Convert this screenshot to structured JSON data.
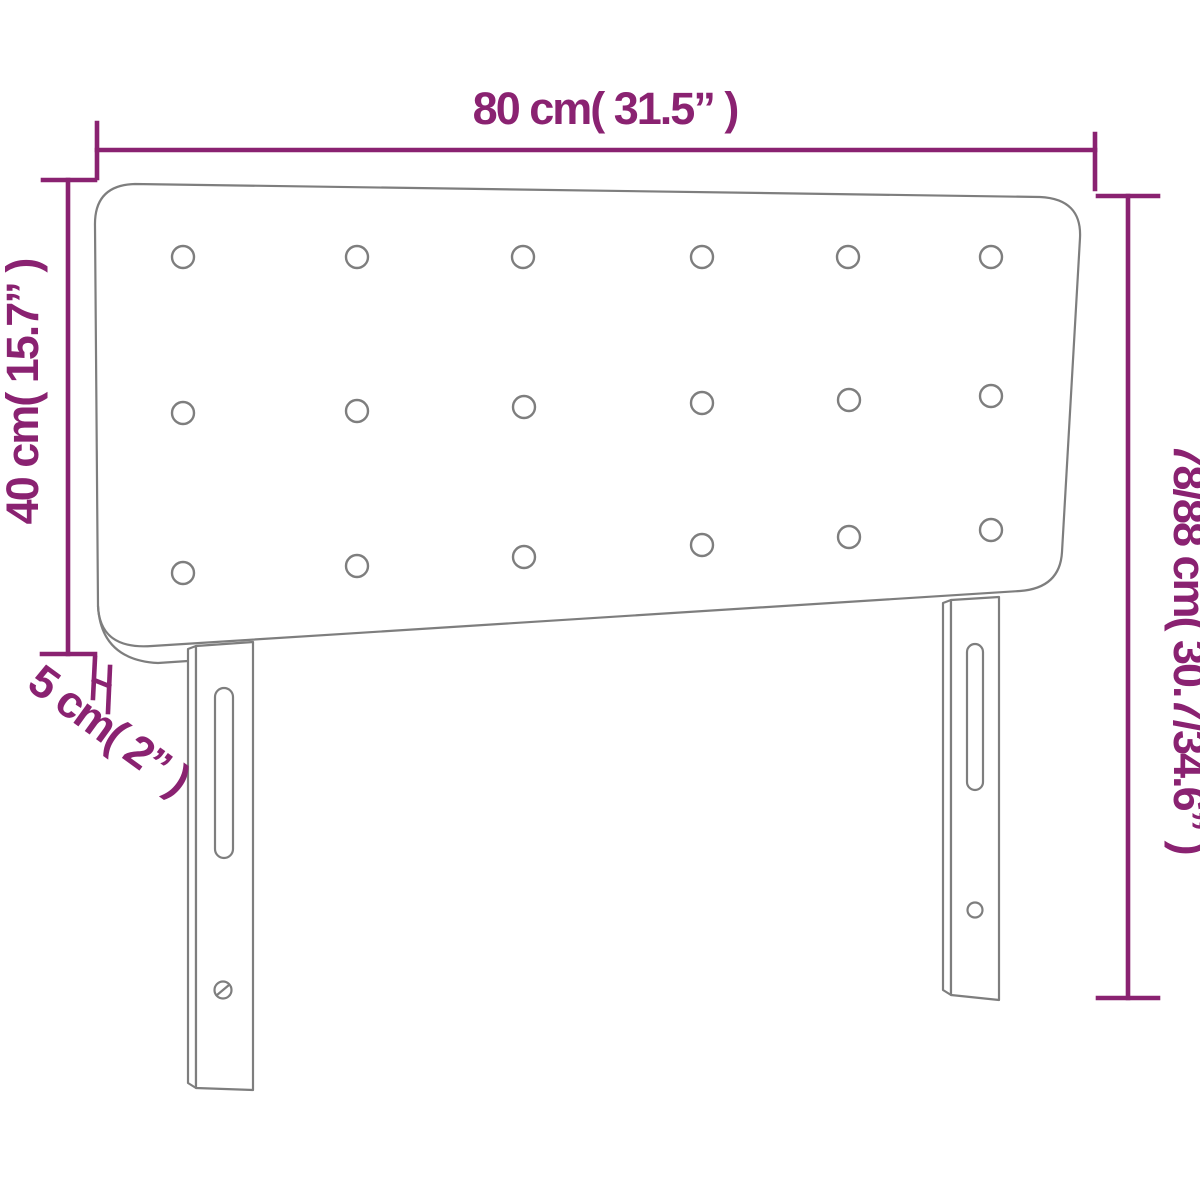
{
  "diagram": {
    "subject": "upholstered headboard with tufted buttons and two adjustable legs",
    "view": "front perspective line drawing",
    "labels": {
      "width": "80 cm( 31.5” )",
      "panel_height": "40 cm( 15.7” )",
      "total_height": "78/88 cm( 30.7/34.6” )",
      "depth": "5 cm( 2” )"
    },
    "measurements": {
      "width_cm": 80,
      "width_in": 31.5,
      "panel_height_cm": 40,
      "panel_height_in": 15.7,
      "total_height_cm": "78/88",
      "total_height_in": "30.7/34.6",
      "depth_cm": 5,
      "depth_in": 2
    },
    "tufting_buttons": {
      "rows": 3,
      "columns": 6,
      "count": 18
    },
    "legs": {
      "count": 2,
      "slot_per_leg": 1,
      "screw_hole_per_leg": 1
    },
    "colors": {
      "dimension": "#8a2271",
      "outline": "#7e7e7e",
      "background": "#ffffff"
    }
  }
}
